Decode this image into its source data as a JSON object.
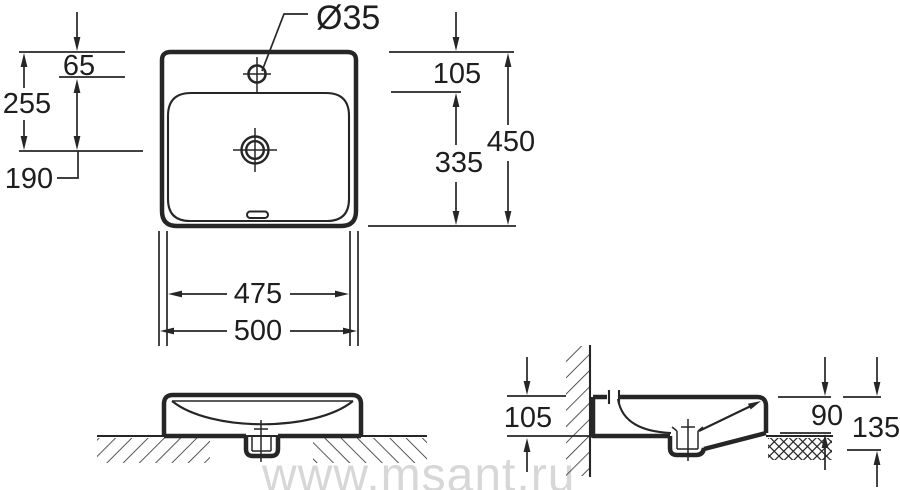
{
  "watermark": {
    "text": "www.msant.ru"
  },
  "dimensions": {
    "top_view": {
      "faucet_hole_diameter": "Ø35",
      "rim_to_faucet_hole": "65",
      "rim_to_drain": "255",
      "drain_offset": "190",
      "rim_to_basin_edge": "105",
      "basin_inner_depth": "335",
      "overall_depth": "450",
      "basin_width": "475",
      "overall_width": "500"
    },
    "side_view": {
      "wall_side_height": "105",
      "front_edge_height": "90",
      "overall_height": "135"
    }
  }
}
